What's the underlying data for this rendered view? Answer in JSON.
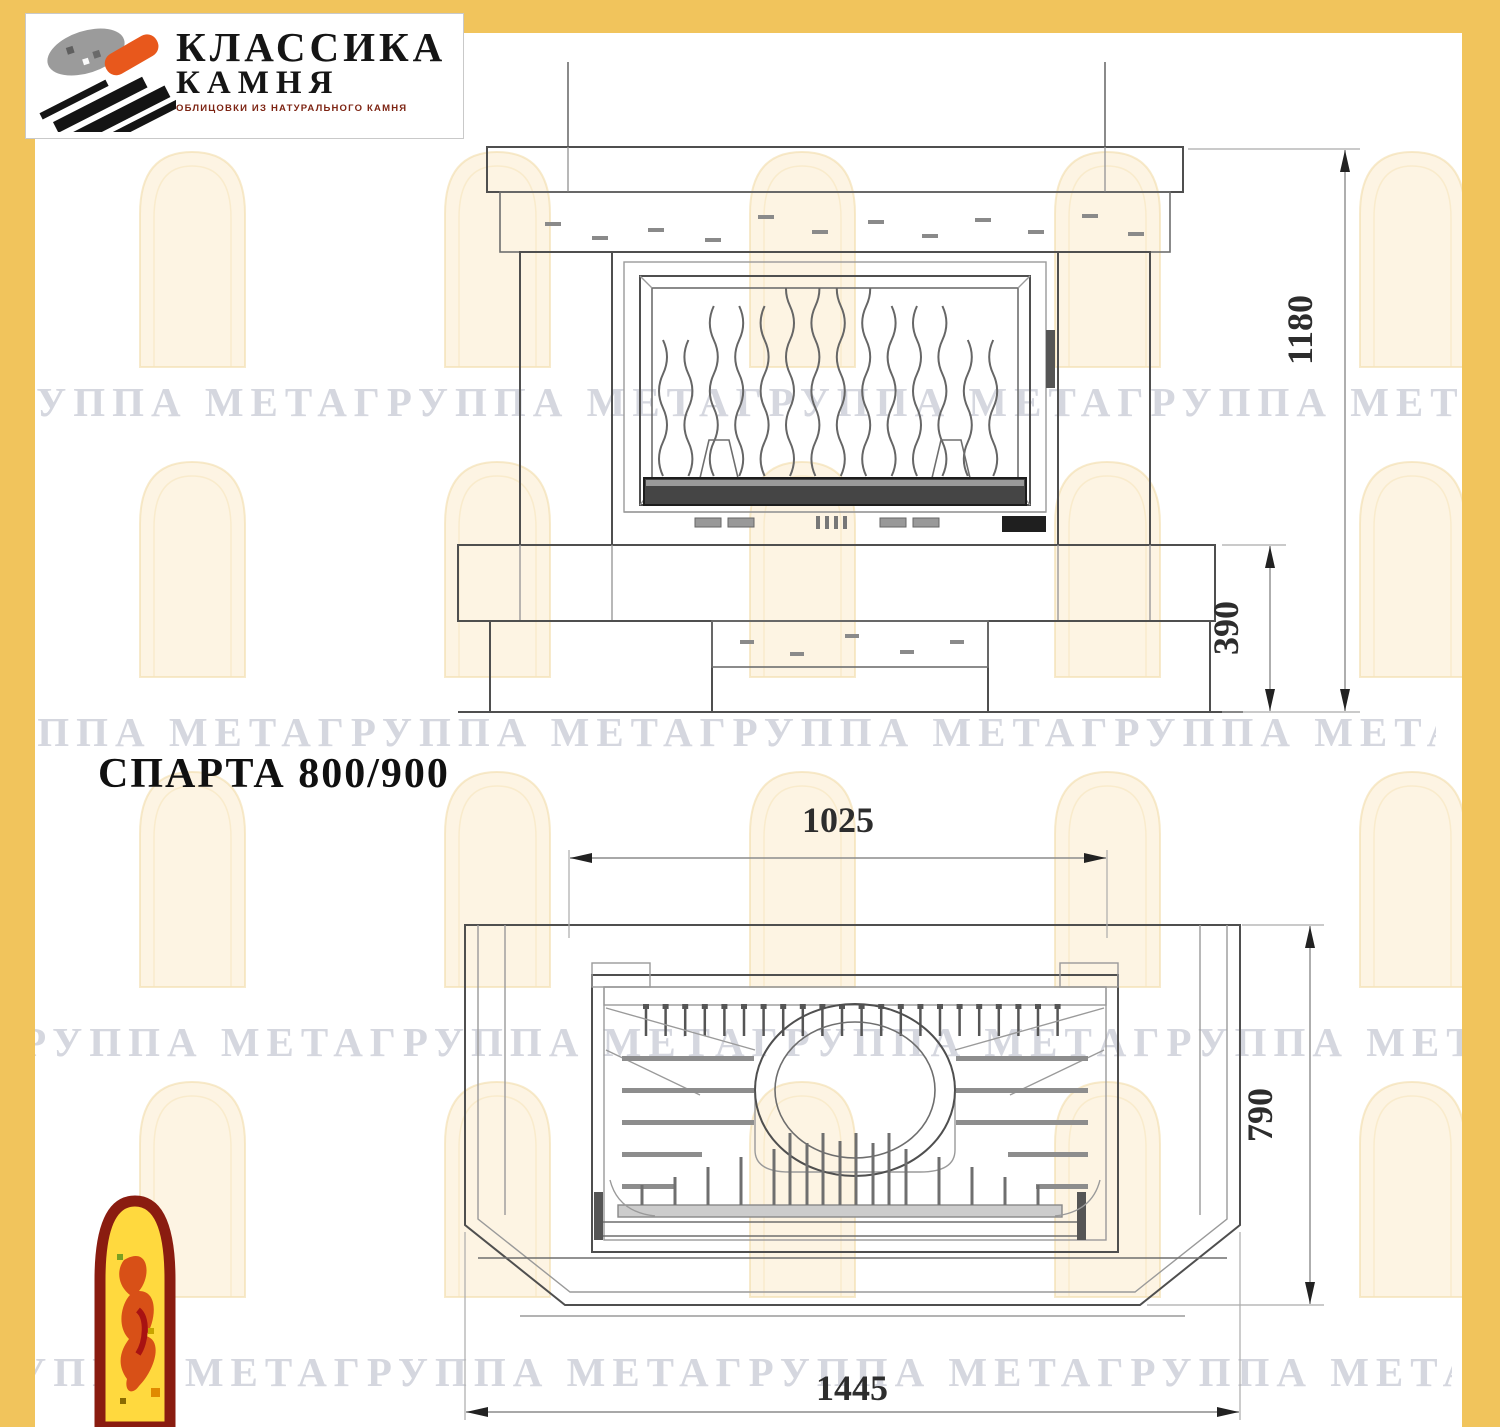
{
  "colors": {
    "frame_yellow": "#f1c45c",
    "paper": "#ffffff",
    "drawing_line": "#4f4f4f",
    "logo_orange": "#e8581c",
    "logo_black": "#151515",
    "logo_subtitle_red": "#7d2413",
    "arch_logo_border": "#8a1c10",
    "arch_logo_fill": "#ffd93e",
    "watermark": "rgba(156,160,178,0.42)"
  },
  "logo": {
    "line1": "КЛАССИКА",
    "line2": "КАМНЯ",
    "subtitle": "ОБЛИЦОВКИ ИЗ НАТУРАЛЬНОГО КАМНЯ"
  },
  "title": "СПАРТА 800/900",
  "watermark_text": "ГРУППА МЕТАГРУППА МЕТАГРУППА МЕТАГРУППА МЕТА",
  "front_view": {
    "name": "fireplace front elevation",
    "dim_height": "1180",
    "dim_base": "390"
  },
  "plan_view": {
    "name": "fireplace plan view",
    "dim_width": "1025",
    "dim_depth": "790",
    "dim_front": "1445"
  }
}
